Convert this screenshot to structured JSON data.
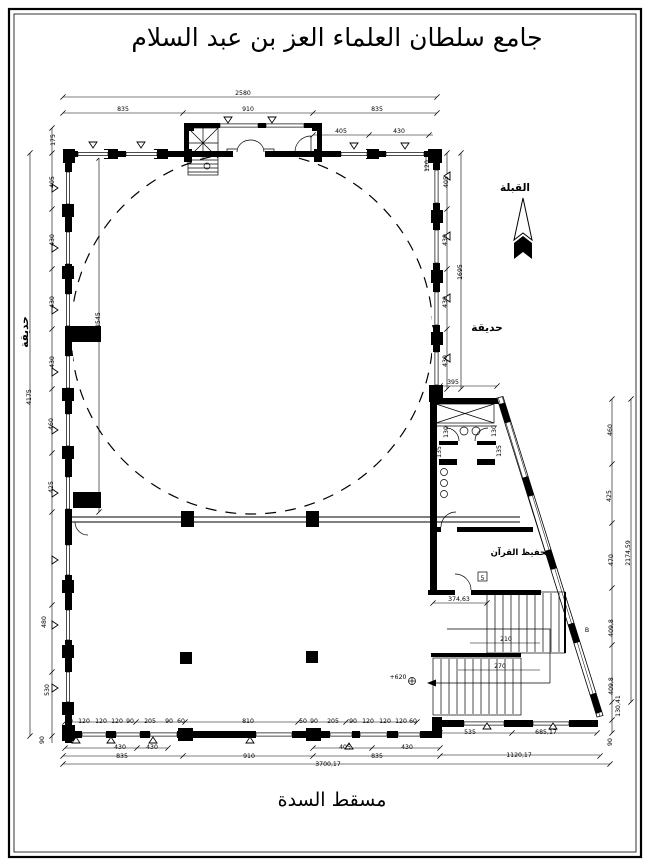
{
  "page": {
    "title": "جامع سلطان العلماء العز بن عبد السلام",
    "caption": "مسقط السدة"
  },
  "compass": {
    "qibla_label": "القبلة"
  },
  "rooms": {
    "garden_left": "حديقة",
    "garden_right": "حديقة",
    "quran_room": "تحفيظ القرآن"
  },
  "plan": {
    "dim_labels": [
      {
        "t": "2580",
        "x": 243,
        "y": 95
      },
      {
        "t": "835",
        "x": 123,
        "y": 111
      },
      {
        "t": "910",
        "x": 248,
        "y": 111
      },
      {
        "t": "835",
        "x": 377,
        "y": 111
      },
      {
        "t": "405",
        "x": 341,
        "y": 133
      },
      {
        "t": "430",
        "x": 399,
        "y": 133
      },
      {
        "t": "120",
        "x": 429,
        "y": 166,
        "r": -90
      },
      {
        "t": "175",
        "x": 55,
        "y": 140,
        "r": -90
      },
      {
        "t": "405",
        "x": 54,
        "y": 182,
        "r": -90
      },
      {
        "t": "430",
        "x": 54,
        "y": 240,
        "r": -90
      },
      {
        "t": "430",
        "x": 54,
        "y": 302,
        "r": -90
      },
      {
        "t": "430",
        "x": 54,
        "y": 362,
        "r": -90
      },
      {
        "t": "460",
        "x": 53,
        "y": 424,
        "r": -90
      },
      {
        "t": "425",
        "x": 53,
        "y": 487,
        "r": -90
      },
      {
        "t": "480",
        "x": 46,
        "y": 622,
        "r": -90
      },
      {
        "t": "530",
        "x": 49,
        "y": 690,
        "r": -90
      },
      {
        "t": "90",
        "x": 44,
        "y": 740,
        "r": -90
      },
      {
        "t": "4175",
        "x": 31,
        "y": 397,
        "r": -90
      },
      {
        "t": "2545",
        "x": 100,
        "y": 320,
        "r": -90
      },
      {
        "t": "405",
        "x": 448,
        "y": 182,
        "r": -90
      },
      {
        "t": "430",
        "x": 447,
        "y": 240,
        "r": -90
      },
      {
        "t": "430",
        "x": 447,
        "y": 302,
        "r": -90
      },
      {
        "t": "430",
        "x": 447,
        "y": 361,
        "r": -90
      },
      {
        "t": "1695",
        "x": 462,
        "y": 272,
        "r": -90
      },
      {
        "t": "395",
        "x": 453,
        "y": 384
      },
      {
        "t": "130",
        "x": 448,
        "y": 432,
        "r": -90,
        "fs": 5
      },
      {
        "t": "130",
        "x": 496,
        "y": 431,
        "r": -90,
        "fs": 5
      },
      {
        "t": "135",
        "x": 441,
        "y": 452,
        "r": -90,
        "fs": 5
      },
      {
        "t": "135",
        "x": 501,
        "y": 451,
        "r": -90,
        "fs": 5
      },
      {
        "t": "460",
        "x": 612,
        "y": 430,
        "r": -90
      },
      {
        "t": "425",
        "x": 611,
        "y": 496,
        "r": -90
      },
      {
        "t": "470",
        "x": 613,
        "y": 560,
        "r": -90
      },
      {
        "t": "409,8",
        "x": 613,
        "y": 628,
        "r": -90
      },
      {
        "t": "409,8",
        "x": 613,
        "y": 686,
        "r": -90
      },
      {
        "t": "130,41",
        "x": 620,
        "y": 706,
        "r": -90
      },
      {
        "t": "90",
        "x": 612,
        "y": 742,
        "r": -90
      },
      {
        "t": "2174,59",
        "x": 630,
        "y": 553,
        "r": -90
      },
      {
        "t": "374,63",
        "x": 459,
        "y": 601,
        "fs": 6
      },
      {
        "t": "210",
        "x": 506,
        "y": 641,
        "fs": 6
      },
      {
        "t": "270",
        "x": 500,
        "y": 668,
        "fs": 6
      },
      {
        "t": "+620",
        "x": 398,
        "y": 679,
        "fs": 6
      },
      {
        "t": "B",
        "x": 587,
        "y": 632,
        "fs": 9
      },
      {
        "t": "5",
        "x": 482.5,
        "y": 580,
        "fs": 6.5
      },
      {
        "t": "60",
        "x": 69,
        "y": 723,
        "fs": 5.2
      },
      {
        "t": "120",
        "x": 84,
        "y": 723,
        "fs": 5.2
      },
      {
        "t": "120",
        "x": 101,
        "y": 723,
        "fs": 5.2
      },
      {
        "t": "120",
        "x": 117,
        "y": 723,
        "fs": 5.2
      },
      {
        "t": "90",
        "x": 130,
        "y": 723,
        "fs": 5.2
      },
      {
        "t": "205",
        "x": 150,
        "y": 723,
        "fs": 5.2
      },
      {
        "t": "90",
        "x": 169,
        "y": 723,
        "fs": 5.2
      },
      {
        "t": "60",
        "x": 181,
        "y": 723,
        "fs": 5.2
      },
      {
        "t": "810",
        "x": 248,
        "y": 723,
        "fs": 5.2
      },
      {
        "t": "50",
        "x": 303,
        "y": 723,
        "fs": 5.2
      },
      {
        "t": "90",
        "x": 314,
        "y": 723,
        "fs": 5.2
      },
      {
        "t": "205",
        "x": 333,
        "y": 723,
        "fs": 5.2
      },
      {
        "t": "90",
        "x": 353,
        "y": 723,
        "fs": 5.2
      },
      {
        "t": "120",
        "x": 368,
        "y": 723,
        "fs": 5.2
      },
      {
        "t": "120",
        "x": 385,
        "y": 723,
        "fs": 5.2
      },
      {
        "t": "120",
        "x": 401,
        "y": 723,
        "fs": 5.2
      },
      {
        "t": "60",
        "x": 413,
        "y": 723,
        "fs": 5.2
      },
      {
        "t": "430",
        "x": 120,
        "y": 749
      },
      {
        "t": "430",
        "x": 152,
        "y": 749
      },
      {
        "t": "405",
        "x": 345,
        "y": 749
      },
      {
        "t": "430",
        "x": 407,
        "y": 749
      },
      {
        "t": "535",
        "x": 470,
        "y": 734
      },
      {
        "t": "685,17",
        "x": 546,
        "y": 734
      },
      {
        "t": "835",
        "x": 122,
        "y": 758
      },
      {
        "t": "910",
        "x": 249,
        "y": 758
      },
      {
        "t": "835",
        "x": 377,
        "y": 758
      },
      {
        "t": "1120,17",
        "x": 519,
        "y": 757
      },
      {
        "t": "3700,17",
        "x": 328,
        "y": 766
      }
    ]
  }
}
